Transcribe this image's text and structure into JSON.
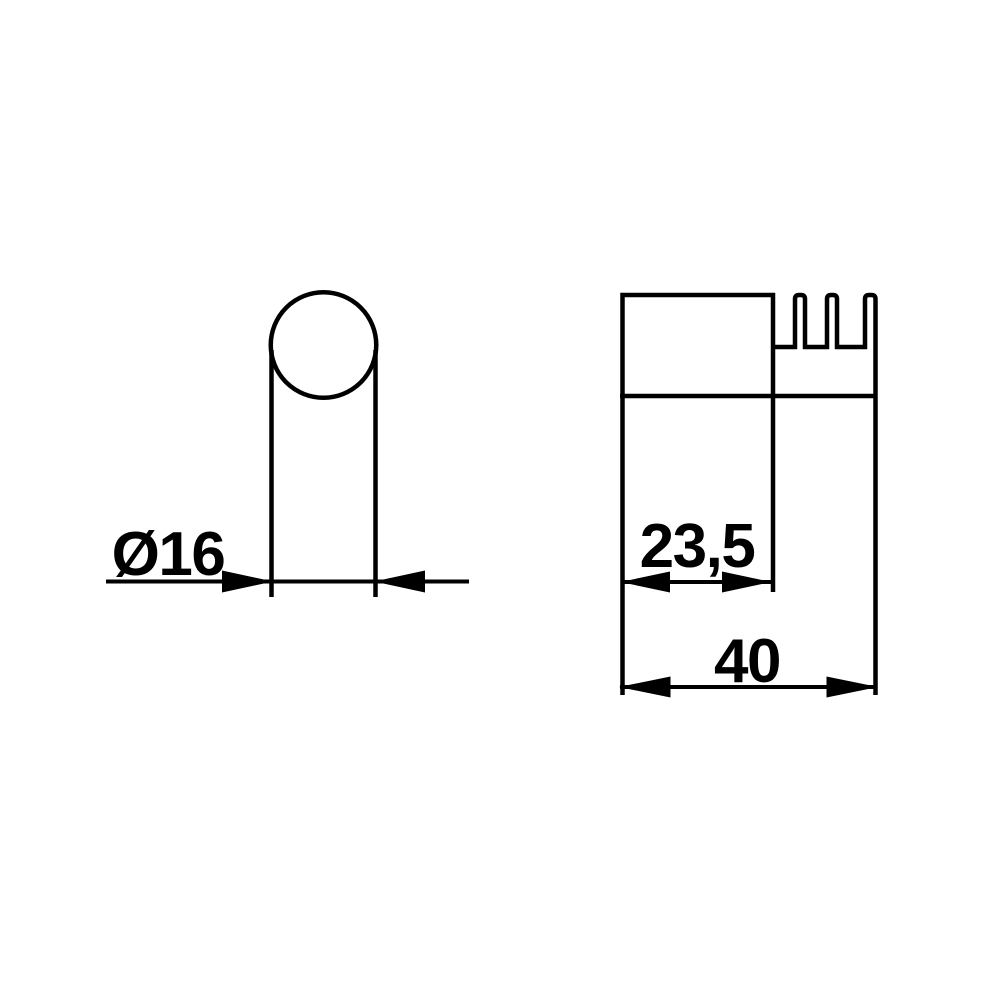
{
  "colors": {
    "ink": "#000000",
    "background": "#ffffff"
  },
  "views": {
    "front": {
      "dimension_diameter": {
        "label": "Ø16"
      }
    },
    "side": {
      "dimension_depth_partial": {
        "label": "23,5"
      },
      "dimension_depth_total": {
        "label": "40"
      }
    }
  }
}
